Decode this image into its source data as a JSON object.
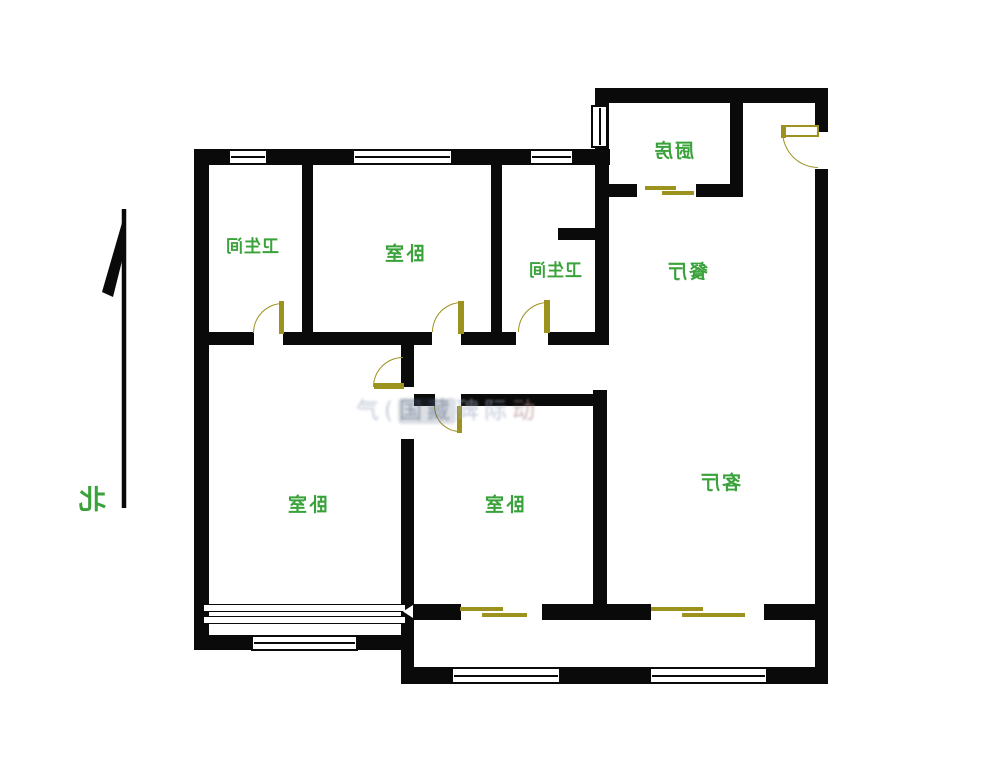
{
  "compass": {
    "label": "北"
  },
  "rooms": [
    {
      "name": "bathroom-1",
      "label": "卫生间"
    },
    {
      "name": "bedroom-north",
      "label": "卧室"
    },
    {
      "name": "bathroom-2",
      "label": "卫生间"
    },
    {
      "name": "kitchen",
      "label": "厨房"
    },
    {
      "name": "dining-room",
      "label": "餐厅"
    },
    {
      "name": "bedroom-west",
      "label": "卧室"
    },
    {
      "name": "bedroom-middle",
      "label": "卧室"
    },
    {
      "name": "living-room",
      "label": "客厅"
    }
  ],
  "watermark": {
    "part1": "气(",
    "part2": "国藏",
    "part3": "碑际",
    "part4": "动"
  },
  "colors": {
    "background": "#ffffff",
    "wall": "#0a0a0a",
    "room_label": "#3aa23a",
    "door": "#9c921e",
    "watermark": "#9fadc2"
  }
}
